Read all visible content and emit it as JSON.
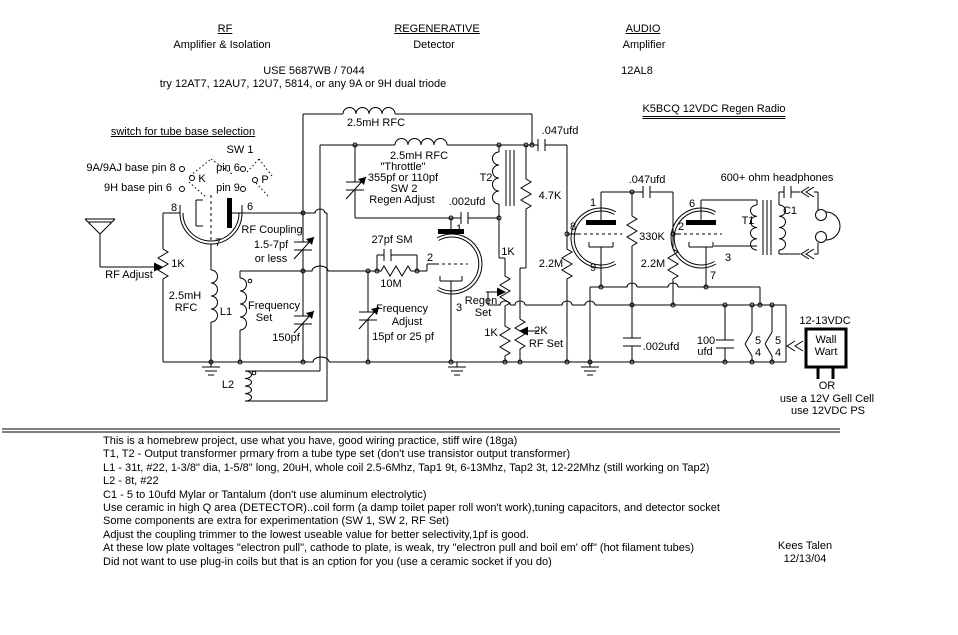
{
  "titles": {
    "rf": "RF",
    "rf_sub": "Amplifier & Isolation",
    "regen": "REGENERATIVE",
    "regen_sub": "Detector",
    "audio": "AUDIO",
    "audio_sub": "Amplifier",
    "use_tube": "USE 5687WB / 7044",
    "try_tube": "try 12AT7, 12AU7, 12U7, 5814, or any 9A or 9H dual triode",
    "audio_tube": "12AL8",
    "project": "K5BCQ 12VDC  Regen Radio"
  },
  "sw1": {
    "heading": "switch for tube base selection",
    "name": "SW 1",
    "row_9a": "9A/9AJ base  pin 8",
    "k": "K",
    "pin6": "pin 6",
    "p": "P",
    "row_9h": "9H base  pin 6",
    "pin9": "pin 9"
  },
  "rf": {
    "pin8": "8",
    "pin7": "7",
    "pin6": "6",
    "adjust": "RF Adjust",
    "r1k": "1K",
    "rfc1": "2.5mH",
    "rfc2": "RFC",
    "coupling": "RF Coupling",
    "coupling_val": "1.5-7pf",
    "coupling_less": "or less",
    "l1": "L1",
    "freq": "Frequency",
    "set": "Set",
    "c150": "150pf",
    "l2": "L2"
  },
  "det": {
    "rfc_top": "2.5mH RFC",
    "rfc_mid": "2.5mH RFC",
    "c047": ".047ufd",
    "throttle": "\"Throttle\"",
    "throttle_val": "355pf or 110pf",
    "sw2": "SW 2",
    "regen_adj": "Regen Adjust",
    "t2": "T2",
    "c002": ".002ufd",
    "r47": "4.7K",
    "c27": "27pf SM",
    "r10m": "10M",
    "fa1": "Frequency",
    "fa2": "Adjust",
    "fa3": "15pf or 25 pf",
    "pin1": "1",
    "pin2": "2",
    "pin3": "3",
    "regen1": "Regen",
    "regen2": "Set",
    "r1k_a": "1K",
    "r1k_b": "1K",
    "r2k": "2K",
    "rfset": "RF Set",
    "r22m": "2.2M",
    "pin8": "8"
  },
  "audio": {
    "c047": ".047ufd",
    "r330k": "330K",
    "r22m": "2.2M",
    "pin1": "1",
    "pin9": "9",
    "pin6": "6",
    "pin2": "2",
    "pin7": "7",
    "pin3": "3",
    "t1": "T1",
    "c1": "C1",
    "phones": "600+ ohm headphones"
  },
  "power": {
    "c002": ".002ufd",
    "c100a": "100",
    "c100b": "ufd",
    "s5a": "5",
    "s4a": "4",
    "s5b": "5",
    "s4b": "4",
    "vdc": "12-13VDC",
    "ww1": "Wall",
    "ww2": "Wart",
    "or": "OR",
    "gell": "use a 12V Gell Cell",
    "ps": "use 12VDC PS"
  },
  "notes": [
    "This is a homebrew project, use what you have, good wiring practice, stiff wire (18ga)",
    "T1, T2 - Output transformer prmary from a tube type set (don't use transistor output transformer)",
    "L1 - 31t, #22, 1-3/8\" dia, 1-5/8\" long, 20uH, whole coil 2.5-6Mhz, Tap1 9t, 6-13Mhz, Tap2 3t, 12-22Mhz (still working on Tap2)",
    "L2 - 8t, #22",
    "C1 - 5 to 10ufd Mylar or Tantalum (don't use aluminum electrolytic)",
    "Use ceramic in high Q area (DETECTOR)..coil form (a damp toilet paper roll won't work),tuning capacitors, and detector socket",
    "Some components are extra for experimentation (SW 1, SW 2, RF Set)",
    "Adjust the coupling trimmer to the lowest useable value for better selectivity,1pf is good.",
    "At these low plate voltages \"electron pull\", cathode to plate, is weak, try \"electron pull and boil em' off\" (hot filament tubes)",
    "Did not want to use plug-in coils but that is an cption for you (use a ceramic socket if you do)"
  ],
  "credit": {
    "name": "Kees Talen",
    "date": "12/13/04"
  }
}
